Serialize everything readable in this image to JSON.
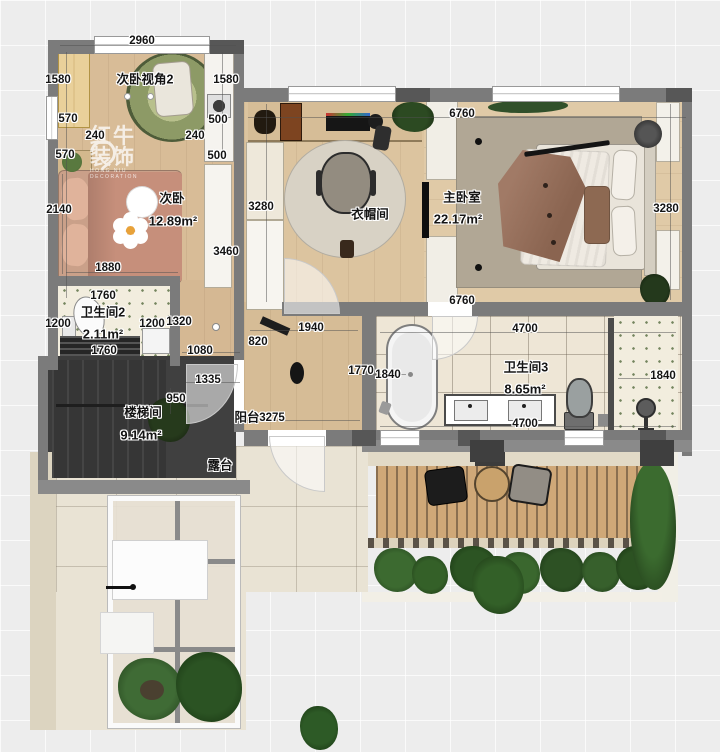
{
  "watermark": {
    "title": "红牛装饰",
    "subtitle": "HONG NIU DECORATION"
  },
  "palette": {
    "wall": "#7b7b7b",
    "wood_floor": "#d8bc97",
    "master_floor": "#e0caa7",
    "stair_dark": "#3c3c3c",
    "tile": "#eee6d6",
    "terrace": "#e9e3d4",
    "deck": "#cfa878",
    "plant_green": "#2c5222",
    "dim_text": "#141414"
  },
  "floorplan": {
    "rooms": [
      {
        "name": "次卧",
        "area": "12.89m²"
      },
      {
        "name": "卫生间2",
        "area": "2.11m²"
      },
      {
        "name": "楼梯间",
        "area": "9.14m²"
      },
      {
        "name": "衣帽间",
        "area": ""
      },
      {
        "name": "主卧室",
        "area": "22.17m²"
      },
      {
        "name": "卫生间3",
        "area": "8.65m²"
      },
      {
        "name": "阳台",
        "area": ""
      },
      {
        "name": "露台",
        "area": ""
      }
    ],
    "labels": [
      {
        "t": "次卧视角2",
        "x": 145,
        "y": 78,
        "k": "view"
      },
      {
        "t": "2960",
        "x": 142,
        "y": 41,
        "k": "dim"
      },
      {
        "t": "1580",
        "x": 58,
        "y": 80,
        "k": "dim"
      },
      {
        "t": "1580",
        "x": 226,
        "y": 80,
        "k": "dim"
      },
      {
        "t": "570",
        "x": 68,
        "y": 119,
        "k": "dim"
      },
      {
        "t": "500",
        "x": 218,
        "y": 120,
        "k": "dim"
      },
      {
        "t": "240",
        "x": 95,
        "y": 136,
        "k": "dim"
      },
      {
        "t": "240",
        "x": 195,
        "y": 136,
        "k": "dim"
      },
      {
        "t": "570",
        "x": 65,
        "y": 155,
        "k": "dim"
      },
      {
        "t": "500",
        "x": 217,
        "y": 156,
        "k": "dim"
      },
      {
        "t": "次卧",
        "x": 172,
        "y": 197,
        "k": "room"
      },
      {
        "t": "12.89m²",
        "x": 173,
        "y": 221,
        "k": "area"
      },
      {
        "t": "2140",
        "x": 59,
        "y": 210,
        "k": "dim"
      },
      {
        "t": "3280",
        "x": 261,
        "y": 207,
        "k": "dim"
      },
      {
        "t": "3460",
        "x": 226,
        "y": 252,
        "k": "dim"
      },
      {
        "t": "1880",
        "x": 108,
        "y": 268,
        "k": "dim"
      },
      {
        "t": "1760",
        "x": 103,
        "y": 296,
        "k": "dim"
      },
      {
        "t": "卫生间2",
        "x": 103,
        "y": 311,
        "k": "room"
      },
      {
        "t": "1200",
        "x": 58,
        "y": 324,
        "k": "dim"
      },
      {
        "t": "1200",
        "x": 152,
        "y": 324,
        "k": "dim"
      },
      {
        "t": "1320",
        "x": 179,
        "y": 322,
        "k": "dim"
      },
      {
        "t": "2.11m²",
        "x": 103,
        "y": 334,
        "k": "area"
      },
      {
        "t": "1760",
        "x": 104,
        "y": 351,
        "k": "dim"
      },
      {
        "t": "1080",
        "x": 200,
        "y": 351,
        "k": "dim"
      },
      {
        "t": "820",
        "x": 258,
        "y": 342,
        "k": "dim"
      },
      {
        "t": "1335",
        "x": 208,
        "y": 380,
        "k": "dim"
      },
      {
        "t": "950",
        "x": 176,
        "y": 399,
        "k": "dim"
      },
      {
        "t": "楼梯间",
        "x": 143,
        "y": 411,
        "k": "room"
      },
      {
        "t": "9.14m²",
        "x": 141,
        "y": 435,
        "k": "area"
      },
      {
        "t": "露台",
        "x": 220,
        "y": 464,
        "k": "room"
      },
      {
        "t": "阳台",
        "x": 247,
        "y": 416,
        "k": "room"
      },
      {
        "t": "3275",
        "x": 272,
        "y": 418,
        "k": "dim"
      },
      {
        "t": "1940",
        "x": 311,
        "y": 328,
        "k": "dim"
      },
      {
        "t": "1770",
        "x": 361,
        "y": 371,
        "k": "dim"
      },
      {
        "t": "1840",
        "x": 388,
        "y": 375,
        "k": "dim"
      },
      {
        "t": "6760",
        "x": 462,
        "y": 114,
        "k": "dim"
      },
      {
        "t": "衣帽间",
        "x": 370,
        "y": 213,
        "k": "room"
      },
      {
        "t": "主卧室",
        "x": 462,
        "y": 196,
        "k": "room"
      },
      {
        "t": "22.17m²",
        "x": 458,
        "y": 219,
        "k": "area"
      },
      {
        "t": "3280",
        "x": 666,
        "y": 209,
        "k": "dim"
      },
      {
        "t": "6760",
        "x": 462,
        "y": 301,
        "k": "dim"
      },
      {
        "t": "4700",
        "x": 525,
        "y": 329,
        "k": "dim"
      },
      {
        "t": "卫生间3",
        "x": 526,
        "y": 366,
        "k": "room"
      },
      {
        "t": "8.65m²",
        "x": 525,
        "y": 389,
        "k": "area"
      },
      {
        "t": "4700",
        "x": 525,
        "y": 424,
        "k": "dim"
      },
      {
        "t": "1840",
        "x": 663,
        "y": 376,
        "k": "dim"
      }
    ]
  }
}
